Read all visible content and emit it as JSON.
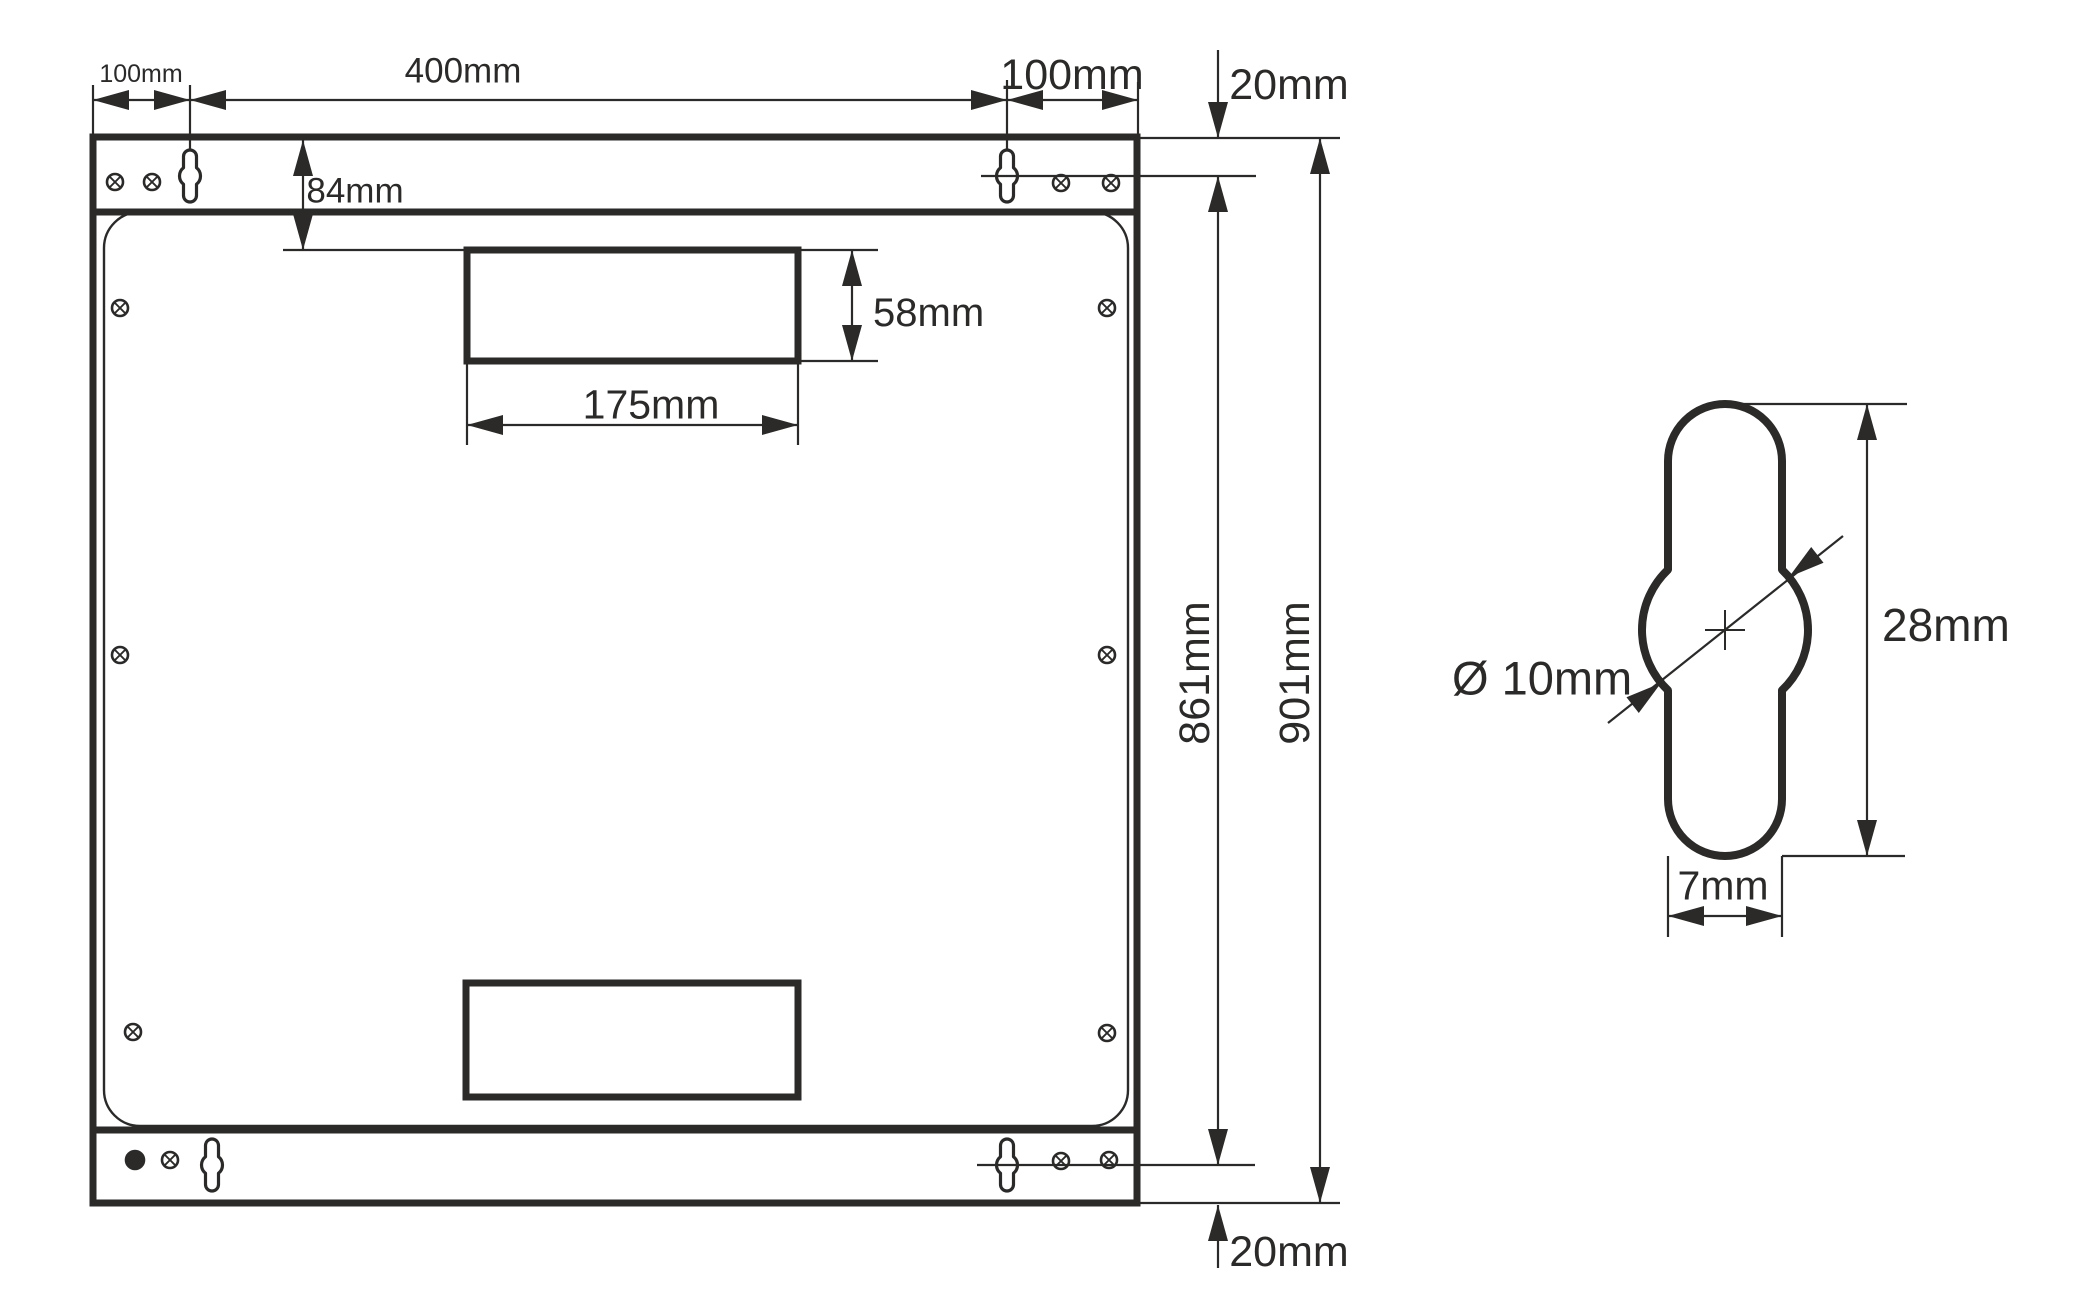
{
  "colors": {
    "ink": "#2b2a29",
    "background": "#ffffff"
  },
  "canvas": {
    "w": 2097,
    "h": 1316
  },
  "drawing": {
    "outlines": [
      {
        "name": "panel-outer-edge",
        "type": "rect",
        "x": 93,
        "y": 137,
        "w": 1044,
        "h": 1066,
        "rx": 0,
        "sw": 7
      },
      {
        "name": "top-flange-bottom-edge",
        "type": "line",
        "x1": 93,
        "y1": 212,
        "x2": 1137,
        "y2": 212,
        "sw": 7
      },
      {
        "name": "bottom-flange-top-edge",
        "type": "line",
        "x1": 93,
        "y1": 1130,
        "x2": 1137,
        "y2": 1130,
        "sw": 7
      },
      {
        "name": "inner-panel-edge",
        "type": "rect",
        "x": 104,
        "y": 212,
        "w": 1024,
        "h": 914,
        "rx": 36,
        "sw": 2.4
      },
      {
        "name": "top-cable-cutout",
        "type": "rect",
        "x": 467,
        "y": 250,
        "w": 331,
        "h": 111,
        "rx": 0,
        "sw": 7
      },
      {
        "name": "bottom-cable-cutout",
        "type": "rect",
        "x": 466,
        "y": 983,
        "w": 332,
        "h": 114,
        "rx": 0,
        "sw": 7
      }
    ],
    "keyholes": [
      {
        "name": "keyhole-slot-top-left",
        "cx": 190,
        "cy": 176,
        "slot_w": 13,
        "slot_h": 52,
        "bulge_r": 10.5,
        "sw": 3.2
      },
      {
        "name": "keyhole-slot-top-right",
        "cx": 1007,
        "cy": 176,
        "slot_w": 13,
        "slot_h": 52,
        "bulge_r": 10.5,
        "sw": 3.2
      },
      {
        "name": "keyhole-slot-bottom-left",
        "cx": 212,
        "cy": 1165,
        "slot_w": 13,
        "slot_h": 52,
        "bulge_r": 10.5,
        "sw": 3.2
      },
      {
        "name": "keyhole-slot-bottom-right",
        "cx": 1007,
        "cy": 1165,
        "slot_w": 13,
        "slot_h": 52,
        "bulge_r": 10.5,
        "sw": 3.2
      },
      {
        "name": "keyhole-slot-detail",
        "cx": 1725,
        "cy": 630,
        "slot_w": 114,
        "slot_h": 452,
        "bulge_r": 83,
        "sw": 8
      }
    ],
    "screws": [
      {
        "name": "screw-top-flange-1",
        "cx": 115,
        "cy": 182,
        "r": 8,
        "filled": false
      },
      {
        "name": "screw-top-flange-2",
        "cx": 152,
        "cy": 182,
        "r": 8,
        "filled": false
      },
      {
        "name": "screw-top-flange-3",
        "cx": 1061,
        "cy": 183,
        "r": 8,
        "filled": false
      },
      {
        "name": "screw-top-flange-4",
        "cx": 1111,
        "cy": 183,
        "r": 8,
        "filled": false
      },
      {
        "name": "screw-bottom-flange-1",
        "cx": 135,
        "cy": 1160,
        "r": 9,
        "filled": true
      },
      {
        "name": "screw-bottom-flange-2",
        "cx": 170,
        "cy": 1160,
        "r": 8,
        "filled": false
      },
      {
        "name": "screw-bottom-flange-3",
        "cx": 1061,
        "cy": 1161,
        "r": 8,
        "filled": false
      },
      {
        "name": "screw-bottom-flange-4",
        "cx": 1109,
        "cy": 1160,
        "r": 8,
        "filled": false
      },
      {
        "name": "screw-panel-top-left",
        "cx": 120,
        "cy": 308,
        "r": 8,
        "filled": false
      },
      {
        "name": "screw-panel-top-right",
        "cx": 1107,
        "cy": 308,
        "r": 8,
        "filled": false
      },
      {
        "name": "screw-panel-mid-left",
        "cx": 120,
        "cy": 655,
        "r": 8,
        "filled": false
      },
      {
        "name": "screw-panel-mid-right",
        "cx": 1107,
        "cy": 655,
        "r": 8,
        "filled": false
      },
      {
        "name": "screw-panel-bottom-left",
        "cx": 133,
        "cy": 1032,
        "r": 8,
        "filled": false
      },
      {
        "name": "screw-panel-bottom-right",
        "cx": 1107,
        "cy": 1033,
        "r": 8,
        "filled": false
      }
    ],
    "ext_lines": [
      {
        "name": "ext-left-edge",
        "x1": 93,
        "y1": 85,
        "x2": 93,
        "y2": 137
      },
      {
        "name": "ext-keyhole-left",
        "x1": 190,
        "y1": 85,
        "x2": 190,
        "y2": 150
      },
      {
        "name": "ext-keyhole-right",
        "x1": 1007,
        "y1": 80,
        "x2": 1007,
        "y2": 150
      },
      {
        "name": "ext-right-edge",
        "x1": 1138,
        "y1": 82,
        "x2": 1138,
        "y2": 137
      },
      {
        "name": "ext-cutout-top-left",
        "x1": 283,
        "y1": 250,
        "x2": 467,
        "y2": 250
      },
      {
        "name": "ext-cutout-top-right",
        "x1": 798,
        "y1": 250,
        "x2": 878,
        "y2": 250
      },
      {
        "name": "ext-cutout-bottom-right",
        "x1": 798,
        "y1": 361,
        "x2": 878,
        "y2": 361
      },
      {
        "name": "ext-175-left",
        "x1": 467,
        "y1": 361,
        "x2": 467,
        "y2": 445
      },
      {
        "name": "ext-175-right",
        "x1": 798,
        "y1": 361,
        "x2": 798,
        "y2": 445
      },
      {
        "name": "ext-top-edge-right",
        "x1": 1140,
        "y1": 138,
        "x2": 1340,
        "y2": 138
      },
      {
        "name": "ext-keyhole-center-top",
        "x1": 981,
        "y1": 176,
        "x2": 1256,
        "y2": 176
      },
      {
        "name": "ext-keyhole-center-bottom",
        "x1": 977,
        "y1": 1165,
        "x2": 1255,
        "y2": 1165
      },
      {
        "name": "ext-bottom-edge-right",
        "x1": 1140,
        "y1": 1203,
        "x2": 1340,
        "y2": 1203
      },
      {
        "name": "ext-detail-top",
        "x1": 1740,
        "y1": 404,
        "x2": 1907,
        "y2": 404
      },
      {
        "name": "ext-detail-bottom",
        "x1": 1782,
        "y1": 856,
        "x2": 1905,
        "y2": 856
      },
      {
        "name": "ext-detail-7mm-left",
        "x1": 1668,
        "y1": 856,
        "x2": 1668,
        "y2": 937
      },
      {
        "name": "ext-detail-7mm-right",
        "x1": 1782,
        "y1": 856,
        "x2": 1782,
        "y2": 937
      }
    ],
    "dim_lines": [
      {
        "name": "dimline-100mm-left",
        "x1": 93,
        "y1": 100,
        "x2": 190,
        "y2": 100
      },
      {
        "name": "dimline-400mm",
        "x1": 190,
        "y1": 100,
        "x2": 1007,
        "y2": 100
      },
      {
        "name": "dimline-100mm-right",
        "x1": 1007,
        "y1": 100,
        "x2": 1138,
        "y2": 100
      },
      {
        "name": "dimline-84mm",
        "x1": 303,
        "y1": 140,
        "x2": 303,
        "y2": 250
      },
      {
        "name": "dimline-58mm",
        "x1": 852,
        "y1": 250,
        "x2": 852,
        "y2": 361
      },
      {
        "name": "dimline-175mm",
        "x1": 467,
        "y1": 425,
        "x2": 798,
        "y2": 425
      },
      {
        "name": "dimline-20mm-top",
        "x1": 1218,
        "y1": 50,
        "x2": 1218,
        "y2": 138
      },
      {
        "name": "dimline-861mm",
        "x1": 1218,
        "y1": 176,
        "x2": 1218,
        "y2": 1165
      },
      {
        "name": "dimline-901mm",
        "x1": 1320,
        "y1": 138,
        "x2": 1320,
        "y2": 1203
      },
      {
        "name": "dimline-20mm-bottom",
        "x1": 1218,
        "y1": 1205,
        "x2": 1218,
        "y2": 1268
      },
      {
        "name": "dimline-28mm",
        "x1": 1867,
        "y1": 404,
        "x2": 1867,
        "y2": 856
      },
      {
        "name": "dimline-7mm",
        "x1": 1668,
        "y1": 916,
        "x2": 1782,
        "y2": 916
      },
      {
        "name": "dimline-10mm-diagonal",
        "x1": 1608,
        "y1": 723,
        "x2": 1843,
        "y2": 536
      }
    ],
    "center_marks": [
      {
        "name": "detail-center-mark-h",
        "x1": 1705,
        "y1": 630,
        "x2": 1745,
        "y2": 630
      },
      {
        "name": "detail-center-mark-v",
        "x1": 1725,
        "y1": 610,
        "x2": 1725,
        "y2": 650
      }
    ],
    "arrows": [
      {
        "name": "arrow-100mm-left-out",
        "x": 93,
        "y": 100,
        "a": 180
      },
      {
        "name": "arrow-100mm-left-in",
        "x": 190,
        "y": 100,
        "a": 0
      },
      {
        "name": "arrow-400mm-left",
        "x": 190,
        "y": 100,
        "a": 180
      },
      {
        "name": "arrow-400mm-right",
        "x": 1007,
        "y": 100,
        "a": 0
      },
      {
        "name": "arrow-100mm-right-in",
        "x": 1007,
        "y": 100,
        "a": 180
      },
      {
        "name": "arrow-100mm-right-out",
        "x": 1138,
        "y": 100,
        "a": 0
      },
      {
        "name": "arrow-84mm-top",
        "x": 303,
        "y": 140,
        "a": 270
      },
      {
        "name": "arrow-84mm-bottom",
        "x": 303,
        "y": 250,
        "a": 90
      },
      {
        "name": "arrow-58mm-top",
        "x": 852,
        "y": 250,
        "a": 270
      },
      {
        "name": "arrow-58mm-bottom",
        "x": 852,
        "y": 361,
        "a": 90
      },
      {
        "name": "arrow-175mm-left",
        "x": 467,
        "y": 425,
        "a": 180
      },
      {
        "name": "arrow-175mm-right",
        "x": 798,
        "y": 425,
        "a": 0
      },
      {
        "name": "arrow-20mm-top",
        "x": 1218,
        "y": 138,
        "a": 90
      },
      {
        "name": "arrow-861mm-top",
        "x": 1218,
        "y": 176,
        "a": 270
      },
      {
        "name": "arrow-861mm-bottom",
        "x": 1218,
        "y": 1165,
        "a": 90
      },
      {
        "name": "arrow-901mm-top",
        "x": 1320,
        "y": 138,
        "a": 270
      },
      {
        "name": "arrow-901mm-bottom",
        "x": 1320,
        "y": 1203,
        "a": 90
      },
      {
        "name": "arrow-20mm-bottom",
        "x": 1218,
        "y": 1205,
        "a": 270
      },
      {
        "name": "arrow-28mm-top",
        "x": 1867,
        "y": 404,
        "a": 270
      },
      {
        "name": "arrow-28mm-bottom",
        "x": 1867,
        "y": 856,
        "a": 90
      },
      {
        "name": "arrow-7mm-left",
        "x": 1668,
        "y": 916,
        "a": 180
      },
      {
        "name": "arrow-7mm-right",
        "x": 1782,
        "y": 916,
        "a": 0
      },
      {
        "name": "arrow-10mm-lower-left",
        "x": 1661,
        "y": 683,
        "a": -38
      },
      {
        "name": "arrow-10mm-upper-right",
        "x": 1789,
        "y": 577,
        "a": 142
      }
    ],
    "labels": [
      {
        "name": "dim-label-100mm-left",
        "text": "100mm",
        "cx": 141,
        "cy": 73,
        "size": 25
      },
      {
        "name": "dim-label-400mm",
        "text": "400mm",
        "cx": 463,
        "cy": 70,
        "size": 35
      },
      {
        "name": "dim-label-100mm-right",
        "text": "100mm",
        "cx": 1072,
        "cy": 74,
        "size": 43
      },
      {
        "name": "dim-label-20mm-top",
        "text": "20mm",
        "cx": 1289,
        "cy": 84,
        "size": 43
      },
      {
        "name": "dim-label-84mm",
        "text": "84mm",
        "cx": 355,
        "cy": 190,
        "size": 35
      },
      {
        "name": "dim-label-58mm",
        "text": "58mm",
        "x": 873,
        "cy": 312,
        "size": 40,
        "anchor": "start"
      },
      {
        "name": "dim-label-175mm",
        "text": "175mm",
        "cx": 651,
        "cy": 404,
        "size": 41
      },
      {
        "name": "dim-label-861mm",
        "text": "861mm",
        "cx": 1194,
        "cy": 673,
        "size": 43,
        "rotate": -90
      },
      {
        "name": "dim-label-901mm",
        "text": "901mm",
        "cx": 1294,
        "cy": 673,
        "size": 43,
        "rotate": -90
      },
      {
        "name": "dim-label-20mm-bottom",
        "text": "20mm",
        "cx": 1289,
        "cy": 1251,
        "size": 43
      },
      {
        "name": "dim-label-diameter-10mm",
        "text": "Ø 10mm",
        "x": 1452,
        "cy": 678,
        "size": 47,
        "anchor": "start"
      },
      {
        "name": "dim-label-28mm",
        "text": "28mm",
        "x": 1882,
        "cy": 625,
        "size": 46,
        "anchor": "start"
      },
      {
        "name": "dim-label-7mm",
        "text": "7mm",
        "cx": 1723,
        "cy": 885,
        "size": 41
      }
    ]
  }
}
